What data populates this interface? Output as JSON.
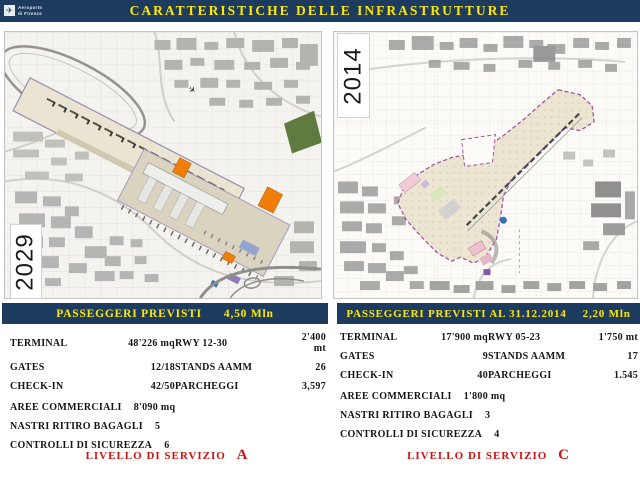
{
  "header": {
    "title": "CARATTERISTICHE DELLE INFRASTRUTTURE",
    "logo_line1": "Aeroporto",
    "logo_line2": "di Firenze"
  },
  "icons": {
    "airplane": "✈"
  },
  "left": {
    "year": "2029",
    "banner_label": "PASSEGGERI PREVISTI",
    "banner_value": "4,50 Mln",
    "table": {
      "col1": [
        {
          "label": "TERMINAL",
          "value": "48'226 mq"
        },
        {
          "label": "GATES",
          "value": "12/18"
        },
        {
          "label": "CHECK-IN",
          "value": "42/50"
        }
      ],
      "col2": [
        {
          "label": "RWY 12-30",
          "value": "2'400 mt"
        },
        {
          "label": "STANDS AAMM",
          "value": "26"
        },
        {
          "label": "PARCHEGGI",
          "value": "3,597"
        }
      ],
      "full": [
        {
          "label": "AREE COMMERCIALI",
          "value": "8'090 mq"
        },
        {
          "label": "NASTRI RITIRO BAGAGLI",
          "value": "5"
        },
        {
          "label": "CONTROLLI DI SICUREZZA",
          "value": "6"
        }
      ]
    },
    "service_label": "LIVELLO DI SERVIZIO",
    "service_value": "A"
  },
  "right": {
    "year": "2014",
    "banner_label": "PASSEGGERI PREVISTI AL 31.12.2014",
    "banner_value": "2,20 Mln",
    "table": {
      "col1": [
        {
          "label": "TERMINAL",
          "value": "17'900 mq"
        },
        {
          "label": "GATES",
          "value": "9"
        },
        {
          "label": "CHECK-IN",
          "value": "40"
        }
      ],
      "col2": [
        {
          "label": "RWY 05-23",
          "value": "1'750 mt"
        },
        {
          "label": "STANDS AAMM",
          "value": "17"
        },
        {
          "label": "PARCHEGGI",
          "value": "1.545"
        }
      ],
      "full": [
        {
          "label": "AREE COMMERCIALI",
          "value": "1'800 mq"
        },
        {
          "label": "NASTRI RITIRO BAGAGLI",
          "value": "3"
        },
        {
          "label": "CONTROLLI DI SICUREZZA",
          "value": "4"
        }
      ]
    },
    "service_label": "LIVELLO DI SERVIZIO",
    "service_value": "C"
  },
  "colors": {
    "header_bg": "#1c3b5e",
    "title_yellow": "#ffe800",
    "service_red": "#cc1313",
    "plan_beige": "#eae5d2",
    "boundary_purple": "#a352a3",
    "forest_green": "#5f7b40",
    "orange": "#ef7d0a"
  }
}
